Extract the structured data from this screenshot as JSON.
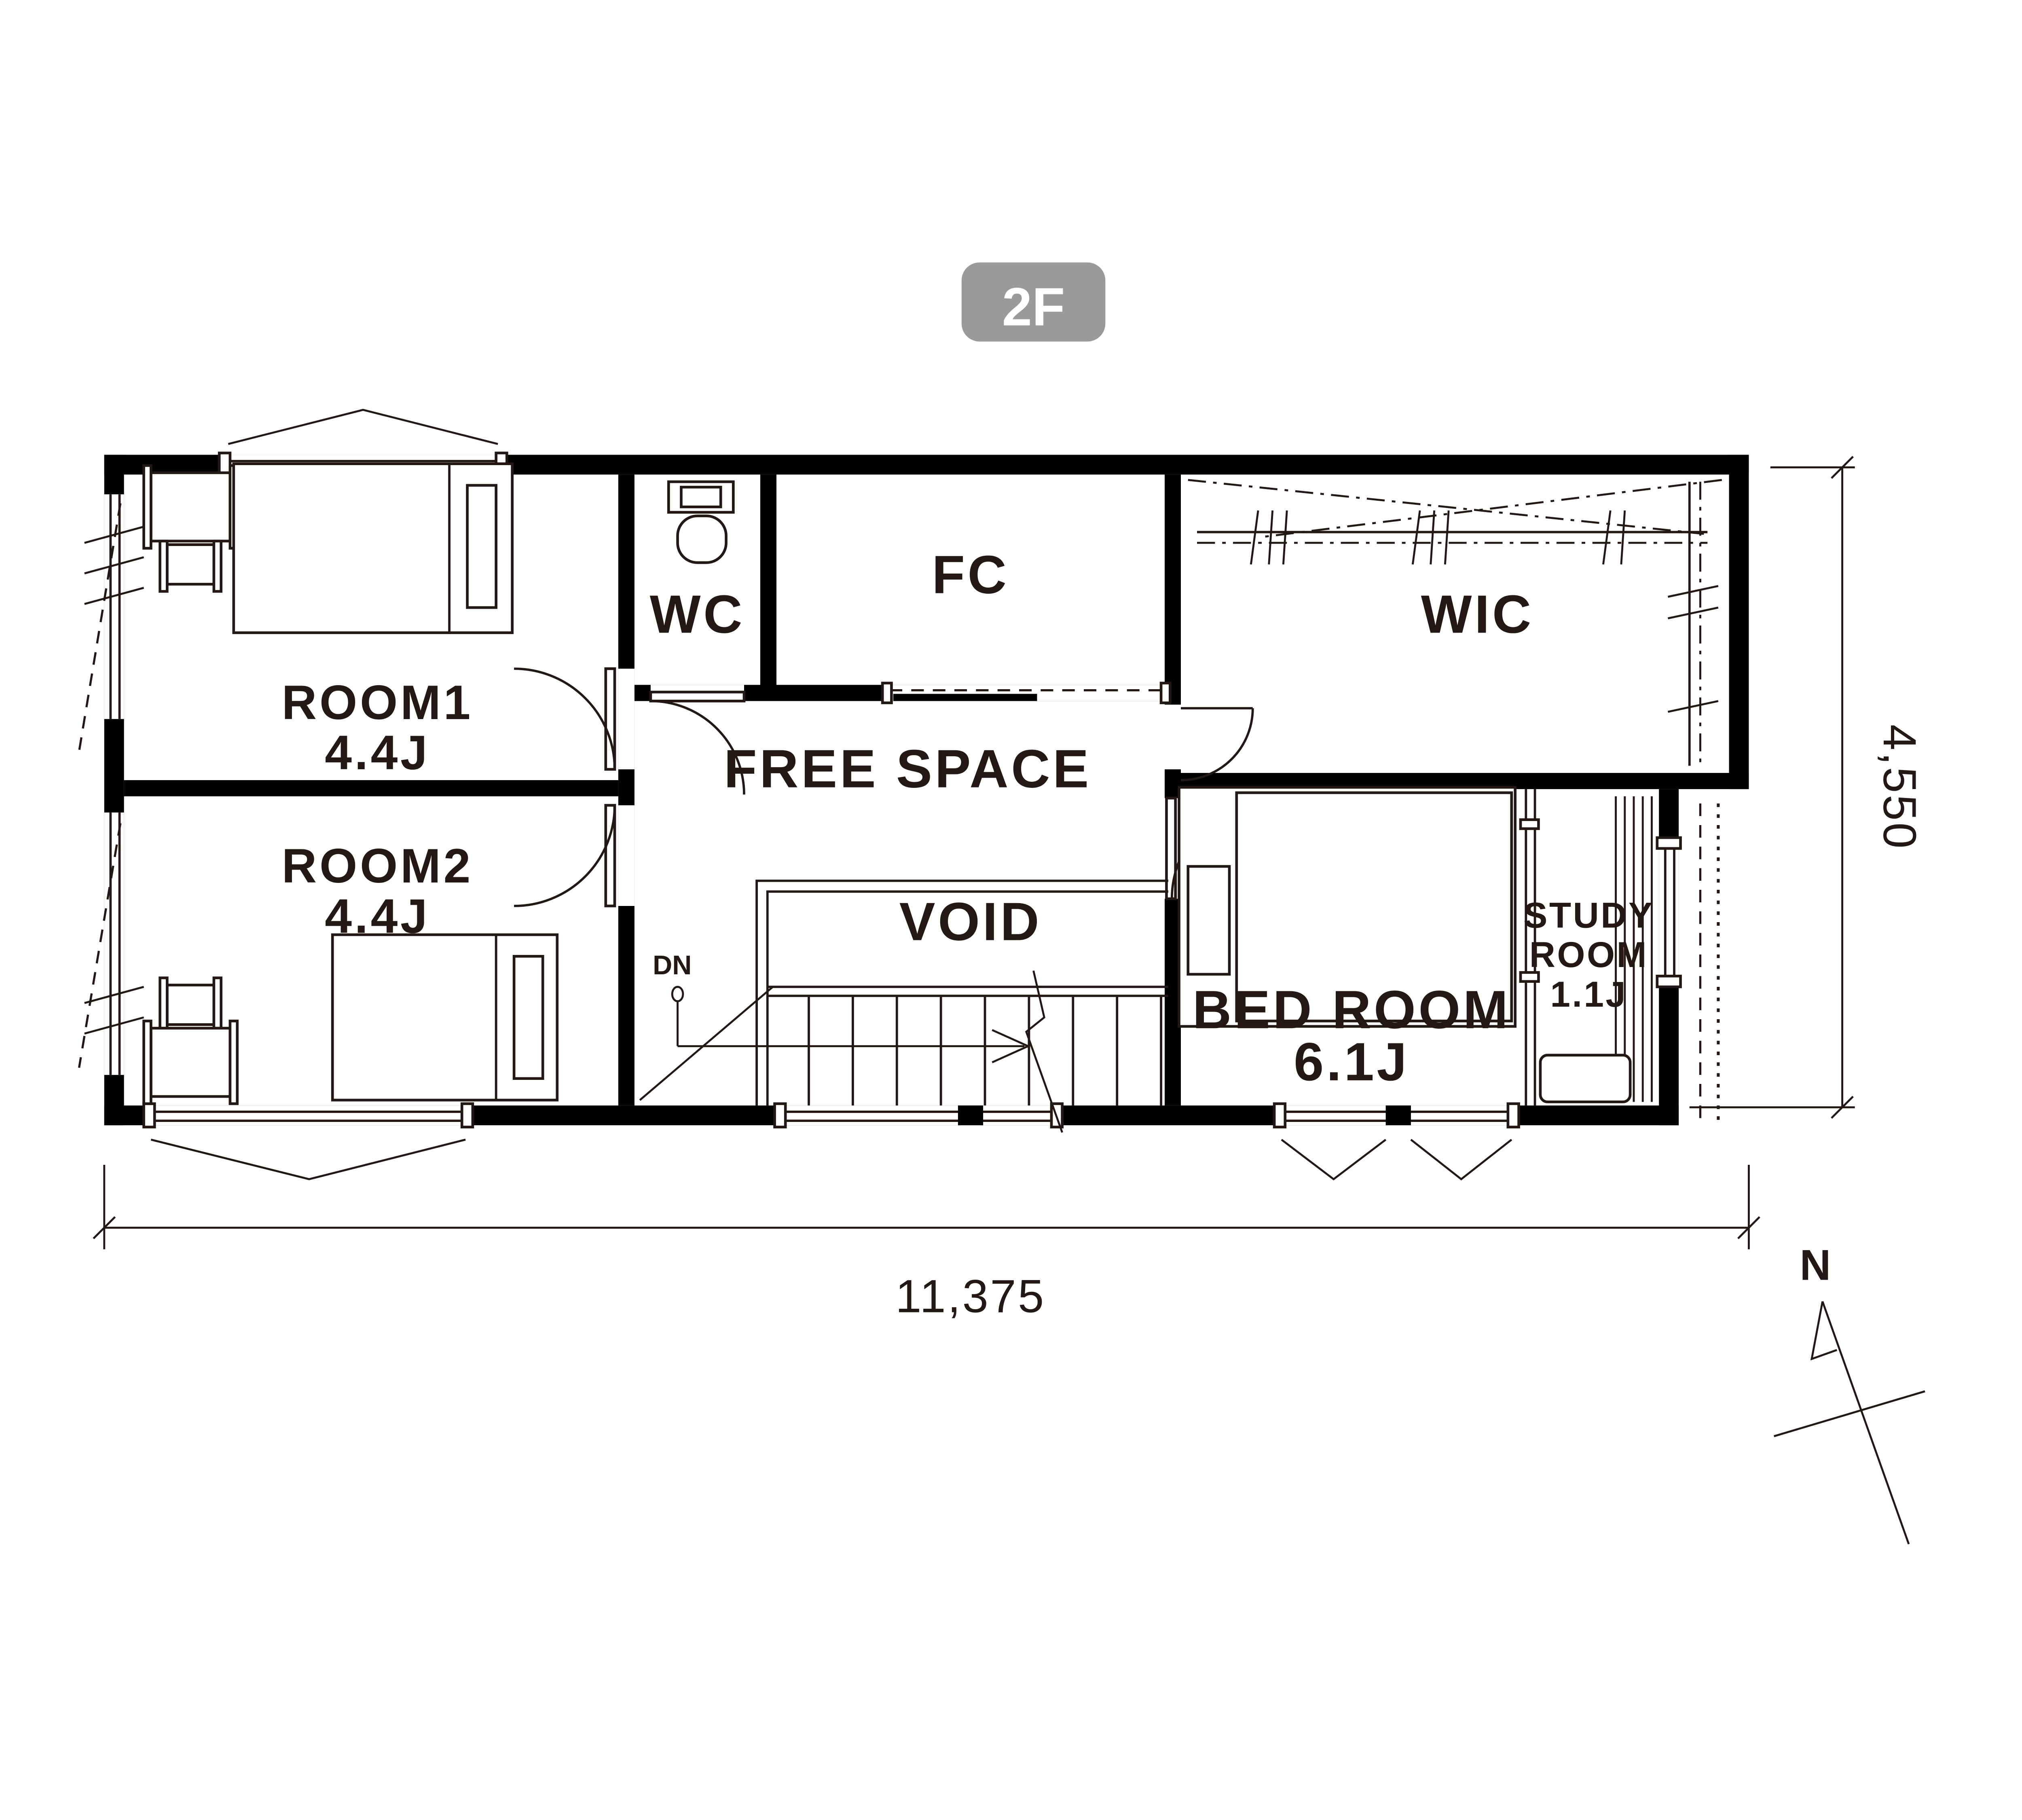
{
  "floor_badge": {
    "label": "2F"
  },
  "rooms": {
    "room1": {
      "name": "ROOM1",
      "area": "4.4J"
    },
    "room2": {
      "name": "ROOM2",
      "area": "4.4J"
    },
    "wc": {
      "name": "WC"
    },
    "fc": {
      "name": "FC"
    },
    "free_space": {
      "name": "FREE SPACE"
    },
    "wic": {
      "name": "WIC"
    },
    "void": {
      "name": "VOID"
    },
    "bedroom": {
      "name": "BED ROOM",
      "area": "6.1J"
    },
    "study_room": {
      "name_line1": "STUDY",
      "name_line2": "ROOM",
      "area": "1.1J"
    }
  },
  "stairs": {
    "direction_label": "DN"
  },
  "dimensions": {
    "width_mm": "11,375",
    "height_mm": "4,550"
  },
  "compass": {
    "north_label": "N"
  },
  "colors": {
    "wall": "#000000",
    "line": "#231815",
    "badge_background": "#9a9a9a",
    "badge_text": "#ffffff",
    "background": "#ffffff"
  }
}
